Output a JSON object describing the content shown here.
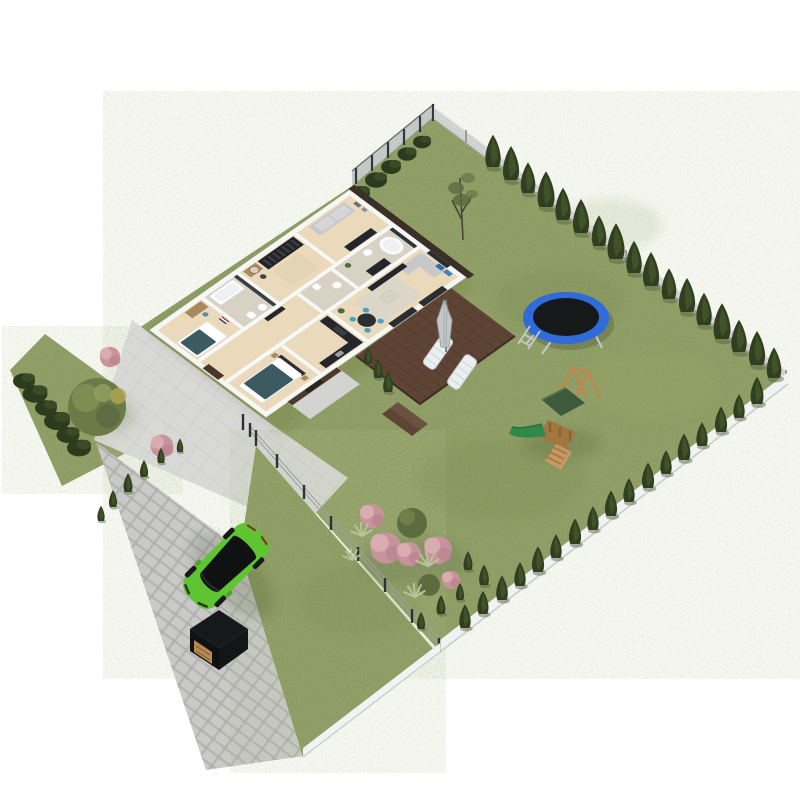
{
  "scene": {
    "description": "3D isometric aerial cutaway render of a single-storey family house with furnished rooms, wooden deck, fenced backyard with trampoline and wooden play set, front garden, cobblestone driveway with a green hatchback car and a black storage box",
    "background": "#ffffff",
    "view": "isometric aerial 3D floor plan"
  },
  "colors": {
    "grass": "#87975c",
    "grass_light": "#9aa86a",
    "grass_dark": "#6f7f46",
    "conifer": "#2f3f1f",
    "conifer_light": "#45582b",
    "bush": "#2c3a1d",
    "tree": "#6b7b48",
    "tree_light": "#7f9055",
    "tree_accent": "#a8a34e",
    "blossom": "#c9939b",
    "blossom_light": "#dcb0b6",
    "tuft": "#b9c29a",
    "path": "#d8d8d6",
    "cobble": "#c9c9c7",
    "cobble_gap": "#b2b2b0",
    "deck": "#5d4434",
    "deck_line": "#4a362a",
    "wall": "#f8f8f6",
    "floor_wood": "#ead9ba",
    "dark_furniture": "#23262a",
    "sofa_gray": "#c6c8ca",
    "rug": "#dcd6c8",
    "teal_bedding": "#3b5a61",
    "blue_chair": "#4d9fc4",
    "blue_art": "#2f6fa3",
    "trampoline_ring": "#2f6bd9",
    "trampoline_mat": "#17181a",
    "trampoline_leg": "#c5c9cc",
    "play_wood": "#b98a50",
    "play_canopy": "#3e5a3c",
    "play_slide": "#2f8a4a",
    "car_green": "#5ec431",
    "car_glass": "#0f1112",
    "box_dark": "#17181a",
    "box_wood": "#b98a50",
    "fence_slat": "#dedede",
    "fence_white": "#f1f3f3",
    "fence_mesh": "#8c9296",
    "fence_post": "#33383c",
    "fence_wire": "#9aa0a3",
    "shadow": "#3c4030"
  },
  "house": {
    "rooms": [
      {
        "name": "lounge",
        "furniture": [
          "gray sofa",
          "tv cabinet",
          "two wall frames"
        ]
      },
      {
        "name": "dressing-room",
        "furniture": [
          "dark wardrobe with clothes",
          "vanity with round mirror",
          "pouf"
        ]
      },
      {
        "name": "bathroom",
        "furniture": [
          "bathtub",
          "toilet",
          "basin",
          "dark accent wall"
        ]
      },
      {
        "name": "kids-room",
        "furniture": [
          "desk",
          "blue chair",
          "single bed with teal duvet",
          "flag artwork"
        ]
      },
      {
        "name": "main-bathroom",
        "furniture": [
          "freestanding oval tub",
          "toilet",
          "dark vanity cabinet",
          "plant"
        ]
      },
      {
        "name": "wc",
        "furniture": [
          "toilet",
          "basin"
        ]
      },
      {
        "name": "hallway",
        "furniture": [
          "console table"
        ]
      },
      {
        "name": "living-room",
        "furniture": [
          "gray corner sofa",
          "media wall unit",
          "coffee table",
          "light rug",
          "two blue wall art panels",
          "glass doors to deck"
        ]
      },
      {
        "name": "dining-area",
        "furniture": [
          "round dark table",
          "4 blue chairs"
        ]
      },
      {
        "name": "kitchen",
        "furniture": [
          "L-shaped black counter",
          "steel sink"
        ]
      },
      {
        "name": "bedroom",
        "furniture": [
          "double bed with teal duvet",
          "white pillows",
          "two nightstands"
        ]
      },
      {
        "name": "entry-porch",
        "furniture": [
          "dark wood cladding",
          "front door"
        ]
      }
    ]
  },
  "deck": {
    "items": [
      "two white sun loungers",
      "closed patio umbrella",
      "wood plank decking",
      "steps to lawn"
    ]
  },
  "yard": {
    "backyard": {
      "items": [
        "trampoline with blue ring, black mat and ladder",
        "wooden play tower with green canopy, green slide, climbing ramp and A-frame swing"
      ],
      "vegetation": [
        "conifer row along right slat fence",
        "conifer row along front-right low fence",
        "shrub row along rear mesh fence",
        "tall young tree",
        "pink blossom trees cluster",
        "olive green trees",
        "ornamental grass tufts",
        "small conifers near corner"
      ]
    },
    "front": {
      "items": [
        "bright green hatchback car on cobblestone driveway",
        "black storage box with wooden front"
      ],
      "vegetation": [
        "large olive-green tree",
        "two pink blossom shrubs",
        "dark conifer hedge along left edge",
        "row of small conifers along walkway",
        "three small conifers by entry porch"
      ]
    },
    "fences": [
      "wire mesh fence (rear-left)",
      "horizontal slat fence (right)",
      "low white fence (front-right)",
      "wire-and-post divider fence",
      "low white fence along lawn tip"
    ]
  },
  "surfaces": [
    "lawn",
    "cobblestone driveway",
    "paved walkway and apron",
    "wooden deck"
  ]
}
